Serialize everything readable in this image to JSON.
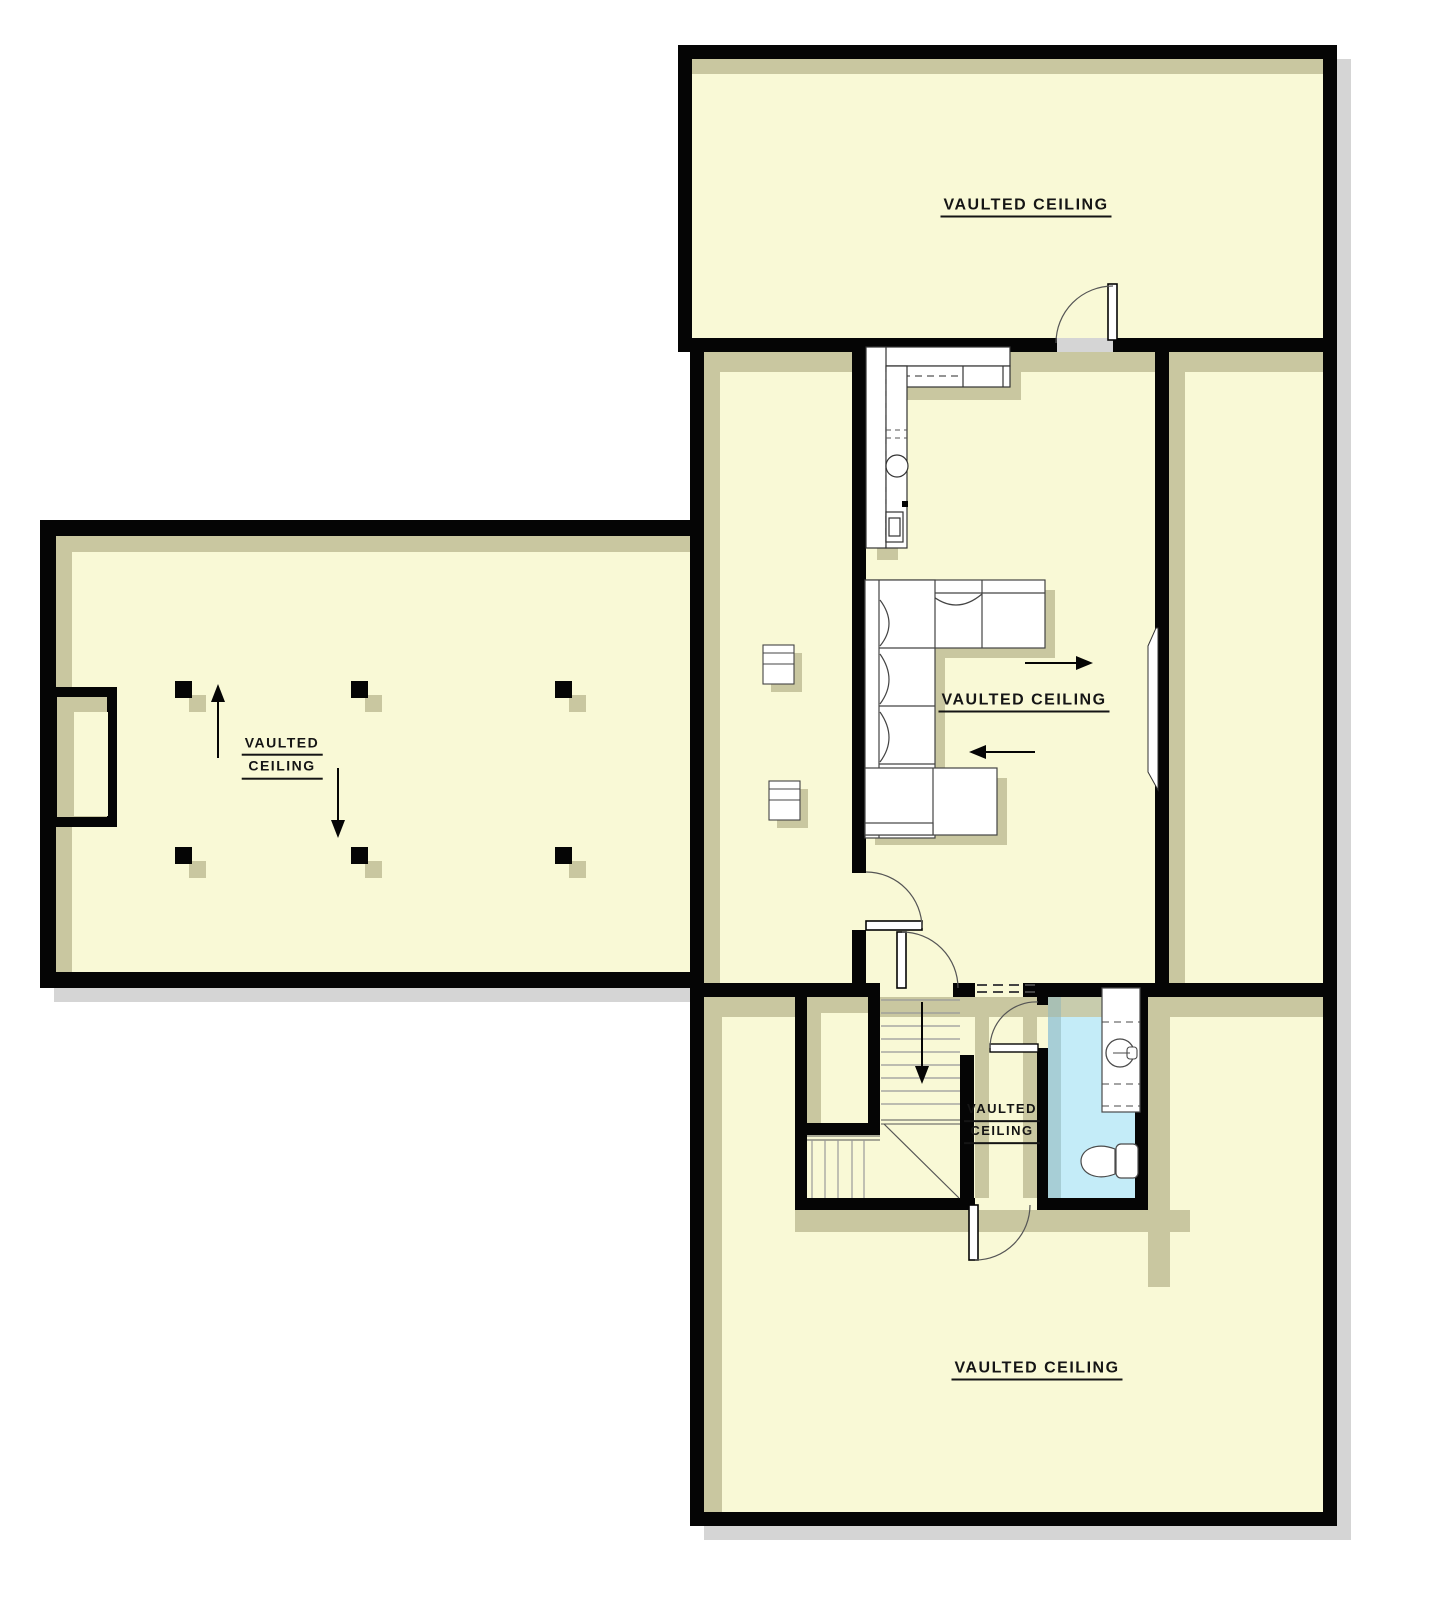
{
  "plan": {
    "title": "Vaulted ceiling floor plan",
    "labels": {
      "top_room": "VAULTED CEILING",
      "wing_line1": "VAULTED",
      "wing_line2": "CEILING",
      "living_room": "VAULTED CEILING",
      "stair_hall_line1": "VAULTED",
      "stair_hall_line2": "CEILING",
      "bottom_room": "VAULTED CEILING"
    },
    "colors": {
      "background": "#ffffff",
      "wall": "#050505",
      "floor": "#f9f9d6",
      "interior_shadow": "#c9c7a0",
      "exterior_shadow": "#d5d5d5",
      "bathroom_floor": "#c4ecf8",
      "fixture_fill": "#ffffff",
      "fixture_stroke": "#4a4a4a",
      "text": "#151515"
    },
    "fixtures": [
      "kitchen-counter",
      "kitchen-sink",
      "sectional-sofa",
      "side-cabinet",
      "stairs-down",
      "winder-stairs",
      "stair-closet",
      "vanity-sink",
      "toilet",
      "window",
      "fireplace-bay",
      "structural-post",
      "door-swing"
    ],
    "arrows": {
      "wing_up": "up",
      "wing_down": "down",
      "living_right": "right",
      "living_left": "left",
      "stairs": "down"
    }
  }
}
